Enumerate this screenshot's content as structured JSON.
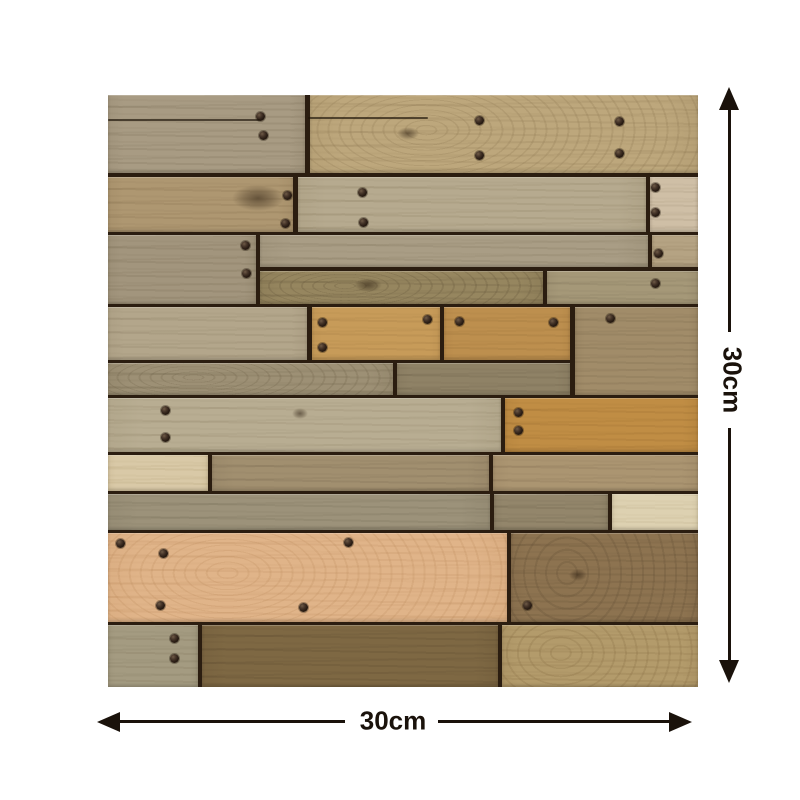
{
  "annotations": {
    "height_label": "30cm",
    "width_label": "30cm",
    "ink_color": "#1a120b"
  },
  "panel": {
    "x": 108,
    "y": 95,
    "width": 590,
    "height": 592,
    "gap_color": "#2b1d10",
    "screw_color": "#271b11",
    "planks": [
      {
        "x": 0,
        "y": 0,
        "w": 197,
        "h": 78,
        "base": "#a89b83",
        "grain": "#71644c"
      },
      {
        "x": 202,
        "y": 0,
        "w": 388,
        "h": 78,
        "base": "#bda77c",
        "grain": "#8a744e",
        "wavy": true
      },
      {
        "x": 0,
        "y": 82,
        "w": 185,
        "h": 55,
        "base": "#ae9771",
        "grain": "#7c6645"
      },
      {
        "x": 190,
        "y": 82,
        "w": 348,
        "h": 55,
        "base": "#b6aa8f",
        "grain": "#857759"
      },
      {
        "x": 542,
        "y": 82,
        "w": 48,
        "h": 55,
        "base": "#cfbfa6",
        "grain": "#97876c"
      },
      {
        "x": 0,
        "y": 140,
        "w": 148,
        "h": 69,
        "base": "#a2957d",
        "grain": "#6f6349"
      },
      {
        "x": 152,
        "y": 140,
        "w": 388,
        "h": 32,
        "base": "#a99d85",
        "grain": "#7a6e54"
      },
      {
        "x": 544,
        "y": 140,
        "w": 46,
        "h": 32,
        "base": "#b5a383",
        "grain": "#84714f"
      },
      {
        "x": 152,
        "y": 176,
        "w": 283,
        "h": 33,
        "base": "#96865f",
        "grain": "#5f5136",
        "wavy": true
      },
      {
        "x": 439,
        "y": 176,
        "w": 151,
        "h": 33,
        "base": "#a59878",
        "grain": "#746850"
      },
      {
        "x": 0,
        "y": 212,
        "w": 199,
        "h": 53,
        "base": "#b3a68b",
        "grain": "#82745a"
      },
      {
        "x": 204,
        "y": 212,
        "w": 128,
        "h": 53,
        "base": "#c79b59",
        "grain": "#96703a"
      },
      {
        "x": 336,
        "y": 212,
        "w": 126,
        "h": 53,
        "base": "#bd8f4e",
        "grain": "#8d6631"
      },
      {
        "x": 467,
        "y": 212,
        "w": 123,
        "h": 88,
        "base": "#a18c69",
        "grain": "#6f5d42"
      },
      {
        "x": 0,
        "y": 268,
        "w": 285,
        "h": 32,
        "base": "#9d9075",
        "grain": "#6b5f45",
        "wavy": true
      },
      {
        "x": 289,
        "y": 268,
        "w": 173,
        "h": 32,
        "base": "#8f8266",
        "grain": "#615640"
      },
      {
        "x": 0,
        "y": 303,
        "w": 393,
        "h": 54,
        "base": "#b8ad92",
        "grain": "#8a7d60"
      },
      {
        "x": 397,
        "y": 303,
        "w": 193,
        "h": 54,
        "base": "#c08d44",
        "grain": "#8d6228"
      },
      {
        "x": 0,
        "y": 360,
        "w": 100,
        "h": 36,
        "base": "#d9c9a7",
        "grain": "#a89467"
      },
      {
        "x": 104,
        "y": 360,
        "w": 277,
        "h": 36,
        "base": "#a18f6f",
        "grain": "#70604a"
      },
      {
        "x": 385,
        "y": 360,
        "w": 205,
        "h": 36,
        "base": "#ab9571",
        "grain": "#7a654a"
      },
      {
        "x": 0,
        "y": 399,
        "w": 382,
        "h": 36,
        "base": "#9c927a",
        "grain": "#6c644e"
      },
      {
        "x": 386,
        "y": 399,
        "w": 114,
        "h": 36,
        "base": "#93866b",
        "grain": "#5f5540"
      },
      {
        "x": 504,
        "y": 399,
        "w": 86,
        "h": 36,
        "base": "#ddd1b1",
        "grain": "#b3a37d"
      },
      {
        "x": 0,
        "y": 438,
        "w": 399,
        "h": 89,
        "base": "#e0b489",
        "grain": "#bb8a5b",
        "wavy": true
      },
      {
        "x": 403,
        "y": 438,
        "w": 187,
        "h": 89,
        "base": "#8d7350",
        "grain": "#5d4a31",
        "wavy": true
      },
      {
        "x": 0,
        "y": 530,
        "w": 90,
        "h": 62,
        "base": "#a49b81",
        "grain": "#756c52"
      },
      {
        "x": 94,
        "y": 530,
        "w": 296,
        "h": 62,
        "base": "#7e6843",
        "grain": "#54422a"
      },
      {
        "x": 394,
        "y": 530,
        "w": 196,
        "h": 62,
        "base": "#b39b6b",
        "grain": "#83693f",
        "wavy": true
      }
    ],
    "screws": [
      [
        152,
        21
      ],
      [
        155,
        40
      ],
      [
        371,
        25
      ],
      [
        371,
        60
      ],
      [
        511,
        26
      ],
      [
        511,
        58
      ],
      [
        179,
        100
      ],
      [
        177,
        128
      ],
      [
        254,
        97
      ],
      [
        255,
        127
      ],
      [
        547,
        92
      ],
      [
        547,
        117
      ],
      [
        137,
        150
      ],
      [
        138,
        178
      ],
      [
        550,
        158
      ],
      [
        547,
        188
      ],
      [
        214,
        227
      ],
      [
        214,
        252
      ],
      [
        319,
        224
      ],
      [
        351,
        226
      ],
      [
        445,
        227
      ],
      [
        502,
        223
      ],
      [
        57,
        315
      ],
      [
        57,
        342
      ],
      [
        410,
        317
      ],
      [
        410,
        335
      ],
      [
        12,
        448
      ],
      [
        55,
        458
      ],
      [
        240,
        447
      ],
      [
        52,
        510
      ],
      [
        195,
        512
      ],
      [
        419,
        510
      ],
      [
        66,
        543
      ],
      [
        66,
        563
      ]
    ],
    "knots": [
      [
        150,
        103,
        52,
        26
      ],
      [
        300,
        38,
        22,
        13
      ],
      [
        192,
        318,
        16,
        11
      ],
      [
        470,
        480,
        18,
        12
      ],
      [
        260,
        190,
        28,
        14
      ]
    ],
    "cracks": [
      [
        0,
        24,
        152
      ],
      [
        200,
        22,
        120
      ]
    ]
  }
}
